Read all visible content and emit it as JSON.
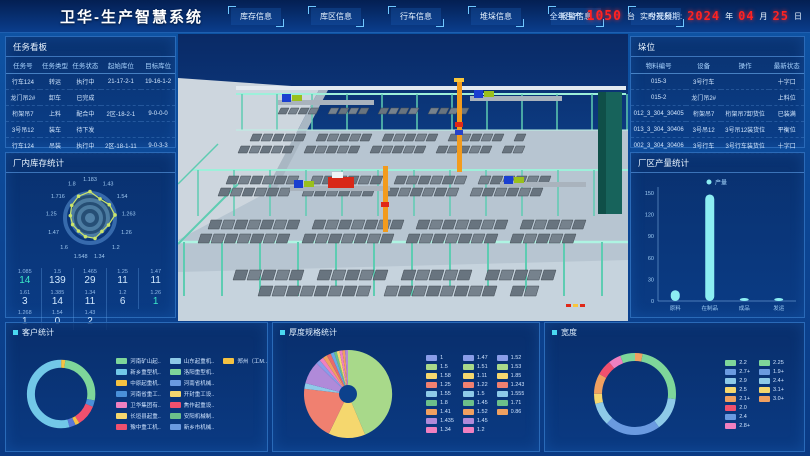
{
  "header": {
    "title": "卫华-生产智慧系统",
    "nav": [
      {
        "label": "库存信息"
      },
      {
        "label": "库区信息"
      },
      {
        "label": "行车信息"
      },
      {
        "label": "堆垛信息"
      },
      {
        "label": "报警信息"
      },
      {
        "label": "实时视频"
      }
    ],
    "annual_label": "全年生产",
    "annual_value": "1050",
    "annual_unit": "台",
    "date_label": "今天日期:",
    "date": {
      "year": "2024",
      "year_unit": "年",
      "month": "04",
      "month_unit": "月",
      "day": "25",
      "day_unit": "日"
    },
    "led_color": "#ff2222"
  },
  "panels": {
    "tasks": {
      "title": "任务看板",
      "columns": [
        "任务号",
        "任务类型",
        "任务状态",
        "起始库位",
        "目标库位"
      ],
      "rows": [
        [
          "行车124",
          "转运",
          "执行中",
          "21-17-2-1",
          "19-16-1-2"
        ],
        [
          "龙门吊2#",
          "卸车",
          "已完成",
          "",
          ""
        ],
        [
          "桁架吊7",
          "上料",
          "配合中",
          "2区-18-2-1",
          "9-0-0-0"
        ],
        [
          "3号吊12",
          "装车",
          "待下发",
          "",
          ""
        ],
        [
          "行车124",
          "吊装",
          "执行中",
          "2区-18-1-11",
          "9-0-3-3"
        ]
      ]
    },
    "factory_stats": {
      "title": "厂内库存统计",
      "radar": {
        "type": "radar",
        "labels": [
          "1.183",
          "1.43",
          "1.54",
          "1.263",
          "1.26",
          "1.2",
          "1.34",
          "1.548",
          "1.6",
          "1.47",
          "1.25",
          "1.716",
          "1.8"
        ],
        "values": [
          88,
          72,
          78,
          84,
          66,
          60,
          70,
          64,
          58,
          62,
          66,
          74,
          82
        ],
        "max": 100,
        "line_color": "#cbe56a"
      },
      "stats": [
        {
          "label": "1.085",
          "value": "14",
          "accent": true
        },
        {
          "label": "1.5",
          "value": "139"
        },
        {
          "label": "1.465",
          "value": "29"
        },
        {
          "label": "1.25",
          "value": "11"
        },
        {
          "label": "1.47",
          "value": "11"
        },
        {
          "label": "1.61",
          "value": "3"
        },
        {
          "label": "1.385",
          "value": "14"
        },
        {
          "label": "1.34",
          "value": "11"
        },
        {
          "label": "1.2",
          "value": "6"
        },
        {
          "label": "1.26",
          "value": "1",
          "accent": true
        },
        {
          "label": "1.268",
          "value": "1"
        },
        {
          "label": "1.54",
          "value": "0"
        },
        {
          "label": "1.43",
          "value": "2"
        }
      ]
    },
    "slots": {
      "title": "垛位",
      "columns": [
        "物料编号",
        "设备",
        "操作",
        "最新状态"
      ],
      "rows": [
        [
          "015-3",
          "3号行车",
          "",
          "十字口"
        ],
        [
          "015-2",
          "龙门吊2#",
          "",
          "上料位"
        ],
        [
          "012_3_304_30405",
          "桁架吊7",
          "桁架吊7卸货位",
          "已装满"
        ],
        [
          "013_3_304_30406",
          "3号吊12",
          "3号吊12装货位",
          "平衡位"
        ],
        [
          "002_3_304_30406",
          "3号行车",
          "3号行车装货位",
          "十字口"
        ]
      ]
    },
    "production": {
      "title": "厂区产量统计",
      "legend": "产量",
      "type": "bar",
      "yticks": [
        150,
        120,
        90,
        60,
        30,
        0
      ],
      "ymax": 150,
      "categories": [
        "原料",
        "在制品",
        "成品",
        "发运"
      ],
      "values": [
        15,
        148,
        4,
        2
      ],
      "bar_color": "#8ceef2"
    },
    "customers": {
      "title": "客户统计",
      "type": "donut",
      "segments": [
        {
          "color": "#f5c242",
          "value": 2
        },
        {
          "color": "#7ed69a",
          "value": 26
        },
        {
          "color": "#4a90d9",
          "value": 3
        },
        {
          "color": "#f0506e",
          "value": 10
        },
        {
          "color": "#f5c242",
          "value": 2
        },
        {
          "color": "#5a78d8",
          "value": 3
        },
        {
          "color": "#72c8e8",
          "value": 54
        }
      ],
      "legend": [
        {
          "color": "#7ed69a",
          "label": "河南矿山起.."
        },
        {
          "color": "#72c8e8",
          "label": "新乡重型机.."
        },
        {
          "color": "#f5c242",
          "label": "中原起重机.."
        },
        {
          "color": "#4a90d9",
          "label": "河南省重工.."
        },
        {
          "color": "#f080c0",
          "label": "卫华集团有.."
        },
        {
          "color": "#f5d76e",
          "label": "长垣县起重.."
        },
        {
          "color": "#f0506e",
          "label": "豫中重工机.."
        },
        {
          "color": "#8ecae8",
          "label": "山东起重机.."
        },
        {
          "color": "#7ed69a",
          "label": "洛阳重型机.."
        },
        {
          "color": "#6a9ae0",
          "label": "河南省机械.."
        },
        {
          "color": "#f5d76e",
          "label": "开封重工设.."
        },
        {
          "color": "#f0506e",
          "label": "焦作起重设.."
        },
        {
          "color": "#6cc08a",
          "label": "安阳机械制.."
        },
        {
          "color": "#6a9ae0",
          "label": "新乡市机械.."
        },
        {
          "color": "#f5c242",
          "label": "郑州（工M.."
        }
      ]
    },
    "thickness": {
      "title": "厚度规格统计",
      "type": "pie",
      "slices": [
        {
          "color": "#a8d98a",
          "value": 42
        },
        {
          "color": "#f5d76e",
          "value": 13
        },
        {
          "color": "#f08070",
          "value": 19
        },
        {
          "color": "#8ecae8",
          "value": 2
        },
        {
          "color": "#b08ad9",
          "value": 8
        },
        {
          "color": "#8a9de8",
          "value": 1.5
        },
        {
          "color": "#f080c0",
          "value": 1.5
        },
        {
          "color": "#f0a060",
          "value": 1.5
        },
        {
          "color": "#e86a6a",
          "value": 1.5
        },
        {
          "color": "#6aa8e8",
          "value": 1.2
        },
        {
          "color": "#6cc08a",
          "value": 1
        },
        {
          "color": "#f5d76e",
          "value": 1
        },
        {
          "color": "#f080c0",
          "value": 1
        },
        {
          "color": "#f0a060",
          "value": 1
        },
        {
          "color": "#b08ad9",
          "value": 1
        }
      ],
      "legend": [
        {
          "color": "#8a9de8",
          "label": "1"
        },
        {
          "color": "#a8d98a",
          "label": "1.5"
        },
        {
          "color": "#f5d76e",
          "label": "1.58"
        },
        {
          "color": "#f08070",
          "label": "1.25"
        },
        {
          "color": "#8ecae8",
          "label": "1.55"
        },
        {
          "color": "#6cc08a",
          "label": "1.8"
        },
        {
          "color": "#f0a060",
          "label": "1.41"
        },
        {
          "color": "#b08ad9",
          "label": "1.435"
        },
        {
          "color": "#f080c0",
          "label": "1.34"
        },
        {
          "color": "#8a9de8",
          "label": "1.47"
        },
        {
          "color": "#a8d98a",
          "label": "1.51"
        },
        {
          "color": "#f5d76e",
          "label": "1.11"
        },
        {
          "color": "#f08070",
          "label": "1.22"
        },
        {
          "color": "#8ecae8",
          "label": "1.5"
        },
        {
          "color": "#6cc08a",
          "label": "1.45"
        },
        {
          "color": "#f0a060",
          "label": "1.52"
        },
        {
          "color": "#b08ad9",
          "label": "1.45"
        },
        {
          "color": "#f080c0",
          "label": "1.2"
        },
        {
          "color": "#8a9de8",
          "label": "1.52"
        },
        {
          "color": "#a8d98a",
          "label": "1.53"
        },
        {
          "color": "#f5d76e",
          "label": "1.85"
        },
        {
          "color": "#f08070",
          "label": "1.243"
        },
        {
          "color": "#8ecae8",
          "label": "1.555"
        },
        {
          "color": "#6cc08a",
          "label": "1.71"
        },
        {
          "color": "#f0a060",
          "label": "0.86"
        }
      ]
    },
    "widths": {
      "title": "宽度",
      "type": "donut",
      "segments": [
        {
          "color": "#f0a060",
          "value": 3
        },
        {
          "color": "#7ed69a",
          "value": 24
        },
        {
          "color": "#8ecae8",
          "value": 13
        },
        {
          "color": "#6a9ae0",
          "value": 22
        },
        {
          "color": "#8ecae8",
          "value": 9
        },
        {
          "color": "#f5d76e",
          "value": 4
        },
        {
          "color": "#f0a060",
          "value": 8
        },
        {
          "color": "#f0506e",
          "value": 6
        },
        {
          "color": "#f080c0",
          "value": 5
        },
        {
          "color": "#7ed69a",
          "value": 6
        }
      ],
      "legend": [
        {
          "color": "#7ed69a",
          "label": "2.2"
        },
        {
          "color": "#6a9ae0",
          "label": "2.7+"
        },
        {
          "color": "#8ecae8",
          "label": "2.9"
        },
        {
          "color": "#f5d76e",
          "label": "2.5"
        },
        {
          "color": "#f0a060",
          "label": "2.1+"
        },
        {
          "color": "#f0506e",
          "label": "2.0"
        },
        {
          "color": "#6a9ae0",
          "label": "2.4"
        },
        {
          "color": "#f080c0",
          "label": "2.8+"
        },
        {
          "color": "#7ed69a",
          "label": "2.25"
        },
        {
          "color": "#6a9ae0",
          "label": "1.9+"
        },
        {
          "color": "#8ecae8",
          "label": "2.4+"
        },
        {
          "color": "#f5d76e",
          "label": "3.1+"
        },
        {
          "color": "#f0a060",
          "label": "3.0+"
        }
      ]
    }
  }
}
